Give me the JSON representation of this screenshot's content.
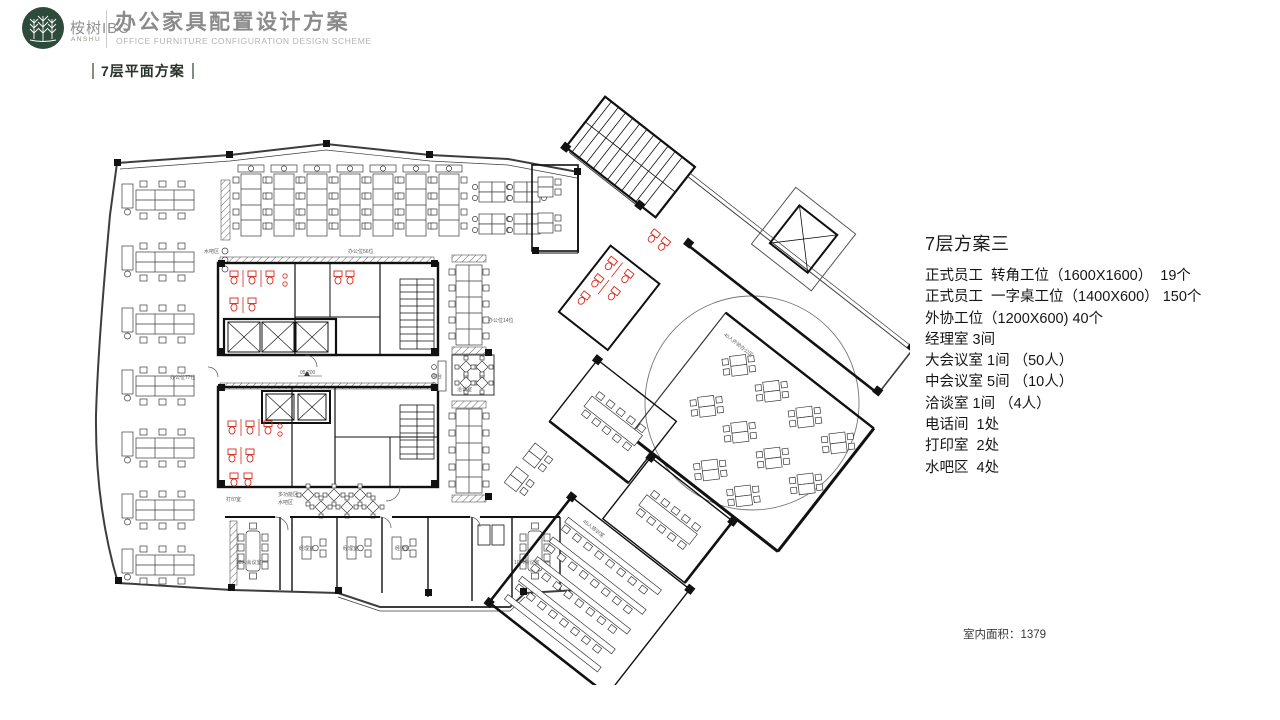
{
  "header": {
    "logo_zh": "桉树IBC",
    "logo_en": "ANSHU",
    "title": "办公家具配置设计方案",
    "subtitle_en": "OFFICE FURNITURE CONFIGURATION DESIGN SCHEME",
    "section_label": "7层平面方案"
  },
  "specs": {
    "title": "7层方案三",
    "items": [
      "正式员工  转角工位（1600X1600）  19个",
      "正式员工  一字桌工位（1400X600） 150个",
      "外协工位（1200X600) 40个",
      "经理室 3间",
      "大会议室 1间 （50人）",
      "中会议室 5间 （10人）",
      "洽谈室 1间 （4人）",
      "电话间  1处",
      "打印室  2处",
      "水吧区  4处"
    ]
  },
  "footer": {
    "area_label": "室内面积：1379"
  },
  "plan": {
    "labels": [
      {
        "t": "水吧区",
        "x": 124,
        "y": 168
      },
      {
        "t": "办公位56位",
        "x": 268,
        "y": 168
      },
      {
        "t": "办公位77位",
        "x": 90,
        "y": 294
      },
      {
        "t": "办公位14位",
        "x": 408,
        "y": 237
      },
      {
        "t": "05.200",
        "x": 220,
        "y": 289
      },
      {
        "t": "打印室",
        "x": 146,
        "y": 416
      },
      {
        "t": "多功能区",
        "x": 198,
        "y": 411
      },
      {
        "t": "水吧区",
        "x": 198,
        "y": 419
      },
      {
        "t": "吧台",
        "x": 352,
        "y": 293
      },
      {
        "t": "洽谈室",
        "x": 377,
        "y": 306
      },
      {
        "t": "10人会议室",
        "x": 156,
        "y": 479
      },
      {
        "t": "经理室",
        "x": 219,
        "y": 465
      },
      {
        "t": "经理室",
        "x": 263,
        "y": 465
      },
      {
        "t": "经理室",
        "x": 315,
        "y": 465
      },
      {
        "t": "10人会议室",
        "x": 434,
        "y": 479
      }
    ],
    "wing_labels": [
      {
        "t": "40人外协办公区",
        "x": 234,
        "y": 99
      },
      {
        "t": "45人培训室",
        "x": 238,
        "y": 333
      }
    ]
  },
  "colors": {
    "logo_green": "#2e4a3b",
    "section_bar": "#7f907f",
    "title_gray": "#8b8b8b",
    "wall_black": "#111111",
    "line_gray": "#3a3a3a",
    "fixture_red": "#d8271a"
  }
}
